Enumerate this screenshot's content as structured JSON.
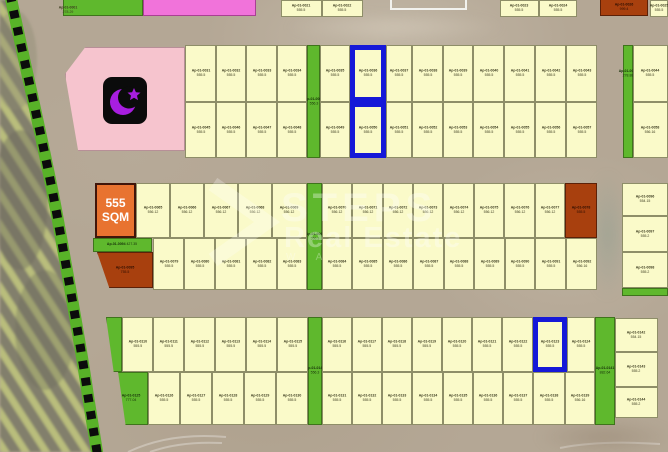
{
  "map_title": "residential land plot map",
  "watermark": {
    "brand": "STEPS",
    "line2": "Real Estate",
    "tagline": "W A"
  },
  "featured_plot": {
    "line1": "555",
    "line2": "SQM"
  },
  "corner_label": {
    "id": "Ap-01-0001",
    "area": "278.29"
  },
  "colors": {
    "plot_yellow": "#fafac9",
    "green": "#5fb82d",
    "brown": "#a8400e",
    "highlight_blue": "#1518d8",
    "featured_orange": "#e87330",
    "mosque_pink": "#f6c4ce",
    "mosque_icon_purple": "#a81ee0",
    "top_strip_pink": "#f173da",
    "road_tan": "#b4a795"
  },
  "strips": {
    "top_green": {
      "id": "Ap-01-0063",
      "area": "556.3"
    },
    "top_right_green": {
      "id": "Ap-01-0064",
      "area": "278.88"
    },
    "mid_green": {
      "id": "Ap-01-0093",
      "area": "556.3"
    },
    "bottom_mid_green": {
      "id": "Ap-01-0140",
      "area": "556.3"
    },
    "bottom_right_green": {
      "id": "Ap-01-0141",
      "area": "882.64"
    },
    "mid_left_green": {
      "id": "Ap-01-0094",
      "area": "427.35"
    },
    "mid_left_brown": {
      "id": "Ap-01-0095",
      "area": "755.5"
    },
    "mid_right_brown": {
      "id": "Ap-01-0078",
      "area": "555.5"
    },
    "top_brown": {
      "id": "Ap-01-0026",
      "area": "999.4"
    },
    "bottom_green_plot": {
      "id": "Ap-01-0125",
      "area": "777.04"
    }
  },
  "plots": {
    "top_partials": [
      "Ap-01-0021|555.5",
      "Ap-01-0022|555.5",
      "Ap-01-0023|555.5",
      "Ap-01-0024|555.5",
      "Ap-01-0025|555.5"
    ],
    "top_row1": [
      "Ap-01-0031|555.5",
      "Ap-01-0032|555.5",
      "Ap-01-0033|555.5",
      "Ap-01-0034|555.5",
      "Ap-01-0035|555.5",
      "Ap-01-0036|555.5",
      "Ap-01-0037|555.5",
      "Ap-01-0038|555.5",
      "Ap-01-0039|555.5",
      "Ap-01-0040|555.5",
      "Ap-01-0041|555.5",
      "Ap-01-0042|555.5",
      "Ap-01-0043|555.5",
      "Ap-01-0044|555.5"
    ],
    "top_row2": [
      "Ap-01-0045|555.5",
      "Ap-01-0046|555.5",
      "Ap-01-0047|555.5",
      "Ap-01-0048|555.5",
      "Ap-01-0049|555.5",
      "Ap-01-0050|555.5",
      "Ap-01-0051|555.5",
      "Ap-01-0052|555.5",
      "Ap-01-0053|555.5",
      "Ap-01-0054|555.5",
      "Ap-01-0055|555.5",
      "Ap-01-0056|555.5",
      "Ap-01-0057|555.5",
      "Ap-01-0058|556.16"
    ],
    "mid_row1": [
      "Ap-01-0065|556.12",
      "Ap-01-0066|556.12",
      "Ap-01-0067|556.12",
      "Ap-01-0068|556.12",
      "Ap-01-0069|556.12",
      "Ap-01-0070|556.12",
      "Ap-01-0071|556.12",
      "Ap-01-0072|556.12",
      "Ap-01-0073|556.12",
      "Ap-01-0074|556.12",
      "Ap-01-0075|556.12",
      "Ap-01-0076|556.12",
      "Ap-01-0077|556.12"
    ],
    "mid_row2": [
      "Ap-01-0079|555.5",
      "Ap-01-0080|555.5",
      "Ap-01-0081|555.5",
      "Ap-01-0082|555.5",
      "Ap-01-0083|555.5",
      "Ap-01-0084|555.5",
      "Ap-01-0085|555.5",
      "Ap-01-0086|555.5",
      "Ap-01-0087|555.5",
      "Ap-01-0088|555.5",
      "Ap-01-0089|555.5",
      "Ap-01-0090|555.5",
      "Ap-01-0091|555.5",
      "Ap-01-0092|556.16"
    ],
    "mid_right_col": [
      "Ap-01-0096|554.15",
      "Ap-01-0097|555.2",
      "Ap-01-0098|555.2"
    ],
    "bottom_row1": [
      "Ap-01-0110|555.5",
      "Ap-01-0111|555.5",
      "Ap-01-0112|555.5",
      "Ap-01-0113|555.5",
      "Ap-01-0114|555.5",
      "Ap-01-0115|555.5",
      "Ap-01-0116|555.5",
      "Ap-01-0117|555.5",
      "Ap-01-0118|555.5",
      "Ap-01-0119|555.5",
      "Ap-01-0120|555.5",
      "Ap-01-0121|555.5",
      "Ap-01-0122|555.5",
      "Ap-01-0123|555.5",
      "Ap-01-0124|555.5"
    ],
    "bottom_row2": [
      "Ap-01-0126|555.5",
      "Ap-01-0127|555.5",
      "Ap-01-0128|555.5",
      "Ap-01-0129|555.5",
      "Ap-01-0130|555.5",
      "Ap-01-0131|555.5",
      "Ap-01-0132|555.5",
      "Ap-01-0133|555.5",
      "Ap-01-0134|555.5",
      "Ap-01-0135|555.5",
      "Ap-01-0136|555.5",
      "Ap-01-0137|555.5",
      "Ap-01-0138|555.5",
      "Ap-01-0139|556.16"
    ],
    "bottom_right_col": [
      "Ap-01-0142|554.15",
      "Ap-01-0143|555.2",
      "Ap-01-0144|555.2"
    ]
  }
}
